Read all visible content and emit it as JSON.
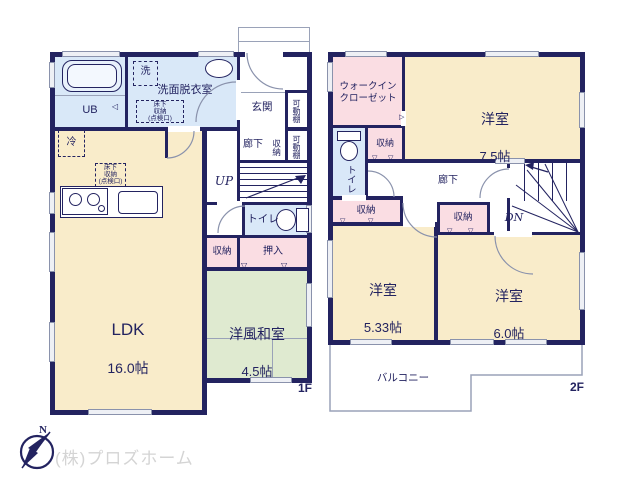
{
  "floor1": {
    "label": "1F",
    "ldk": {
      "name": "LDK",
      "size": "16.0帖"
    },
    "washitsu": {
      "name": "洋風和室",
      "size": "4.5帖"
    },
    "ub": "UB",
    "washroom": "洗面脱衣室",
    "laundry": "洗",
    "genkan": "玄関",
    "hall": "廊下",
    "toilet": "トイレ",
    "up": "UP",
    "fridge": "冷",
    "underfloor_washroom": "床下\n収納\n(点検口)",
    "underfloor_ldk": "床下\n収納\n(点検口)",
    "shelf_upper": "可動棚",
    "shelf_lower": "可動棚",
    "shelf_storage": "収納",
    "closet": "収納",
    "oshiire": "押入"
  },
  "floor2": {
    "label": "2F",
    "wic": "ウォークイン\nクローゼット",
    "room75": {
      "name": "洋室",
      "size": "7.5帖"
    },
    "room533": {
      "name": "洋室",
      "size": "5.33帖"
    },
    "room60": {
      "name": "洋室",
      "size": "6.0帖"
    },
    "toilet": "トイレ",
    "hall": "廊下",
    "dn": "DN",
    "balcony": "バルコニー",
    "closet_a": "収納",
    "closet_b": "収納",
    "closet_c": "収納"
  },
  "footer": {
    "company": "(株)プロズホーム",
    "compass_north": "N"
  },
  "colors": {
    "wall": "#232360",
    "room_main": "#f9ecca",
    "room_tatami": "#dfead0",
    "room_storage": "#fadde3",
    "room_wet": "#d9e8f8",
    "company_text": "#d4d4d4"
  }
}
